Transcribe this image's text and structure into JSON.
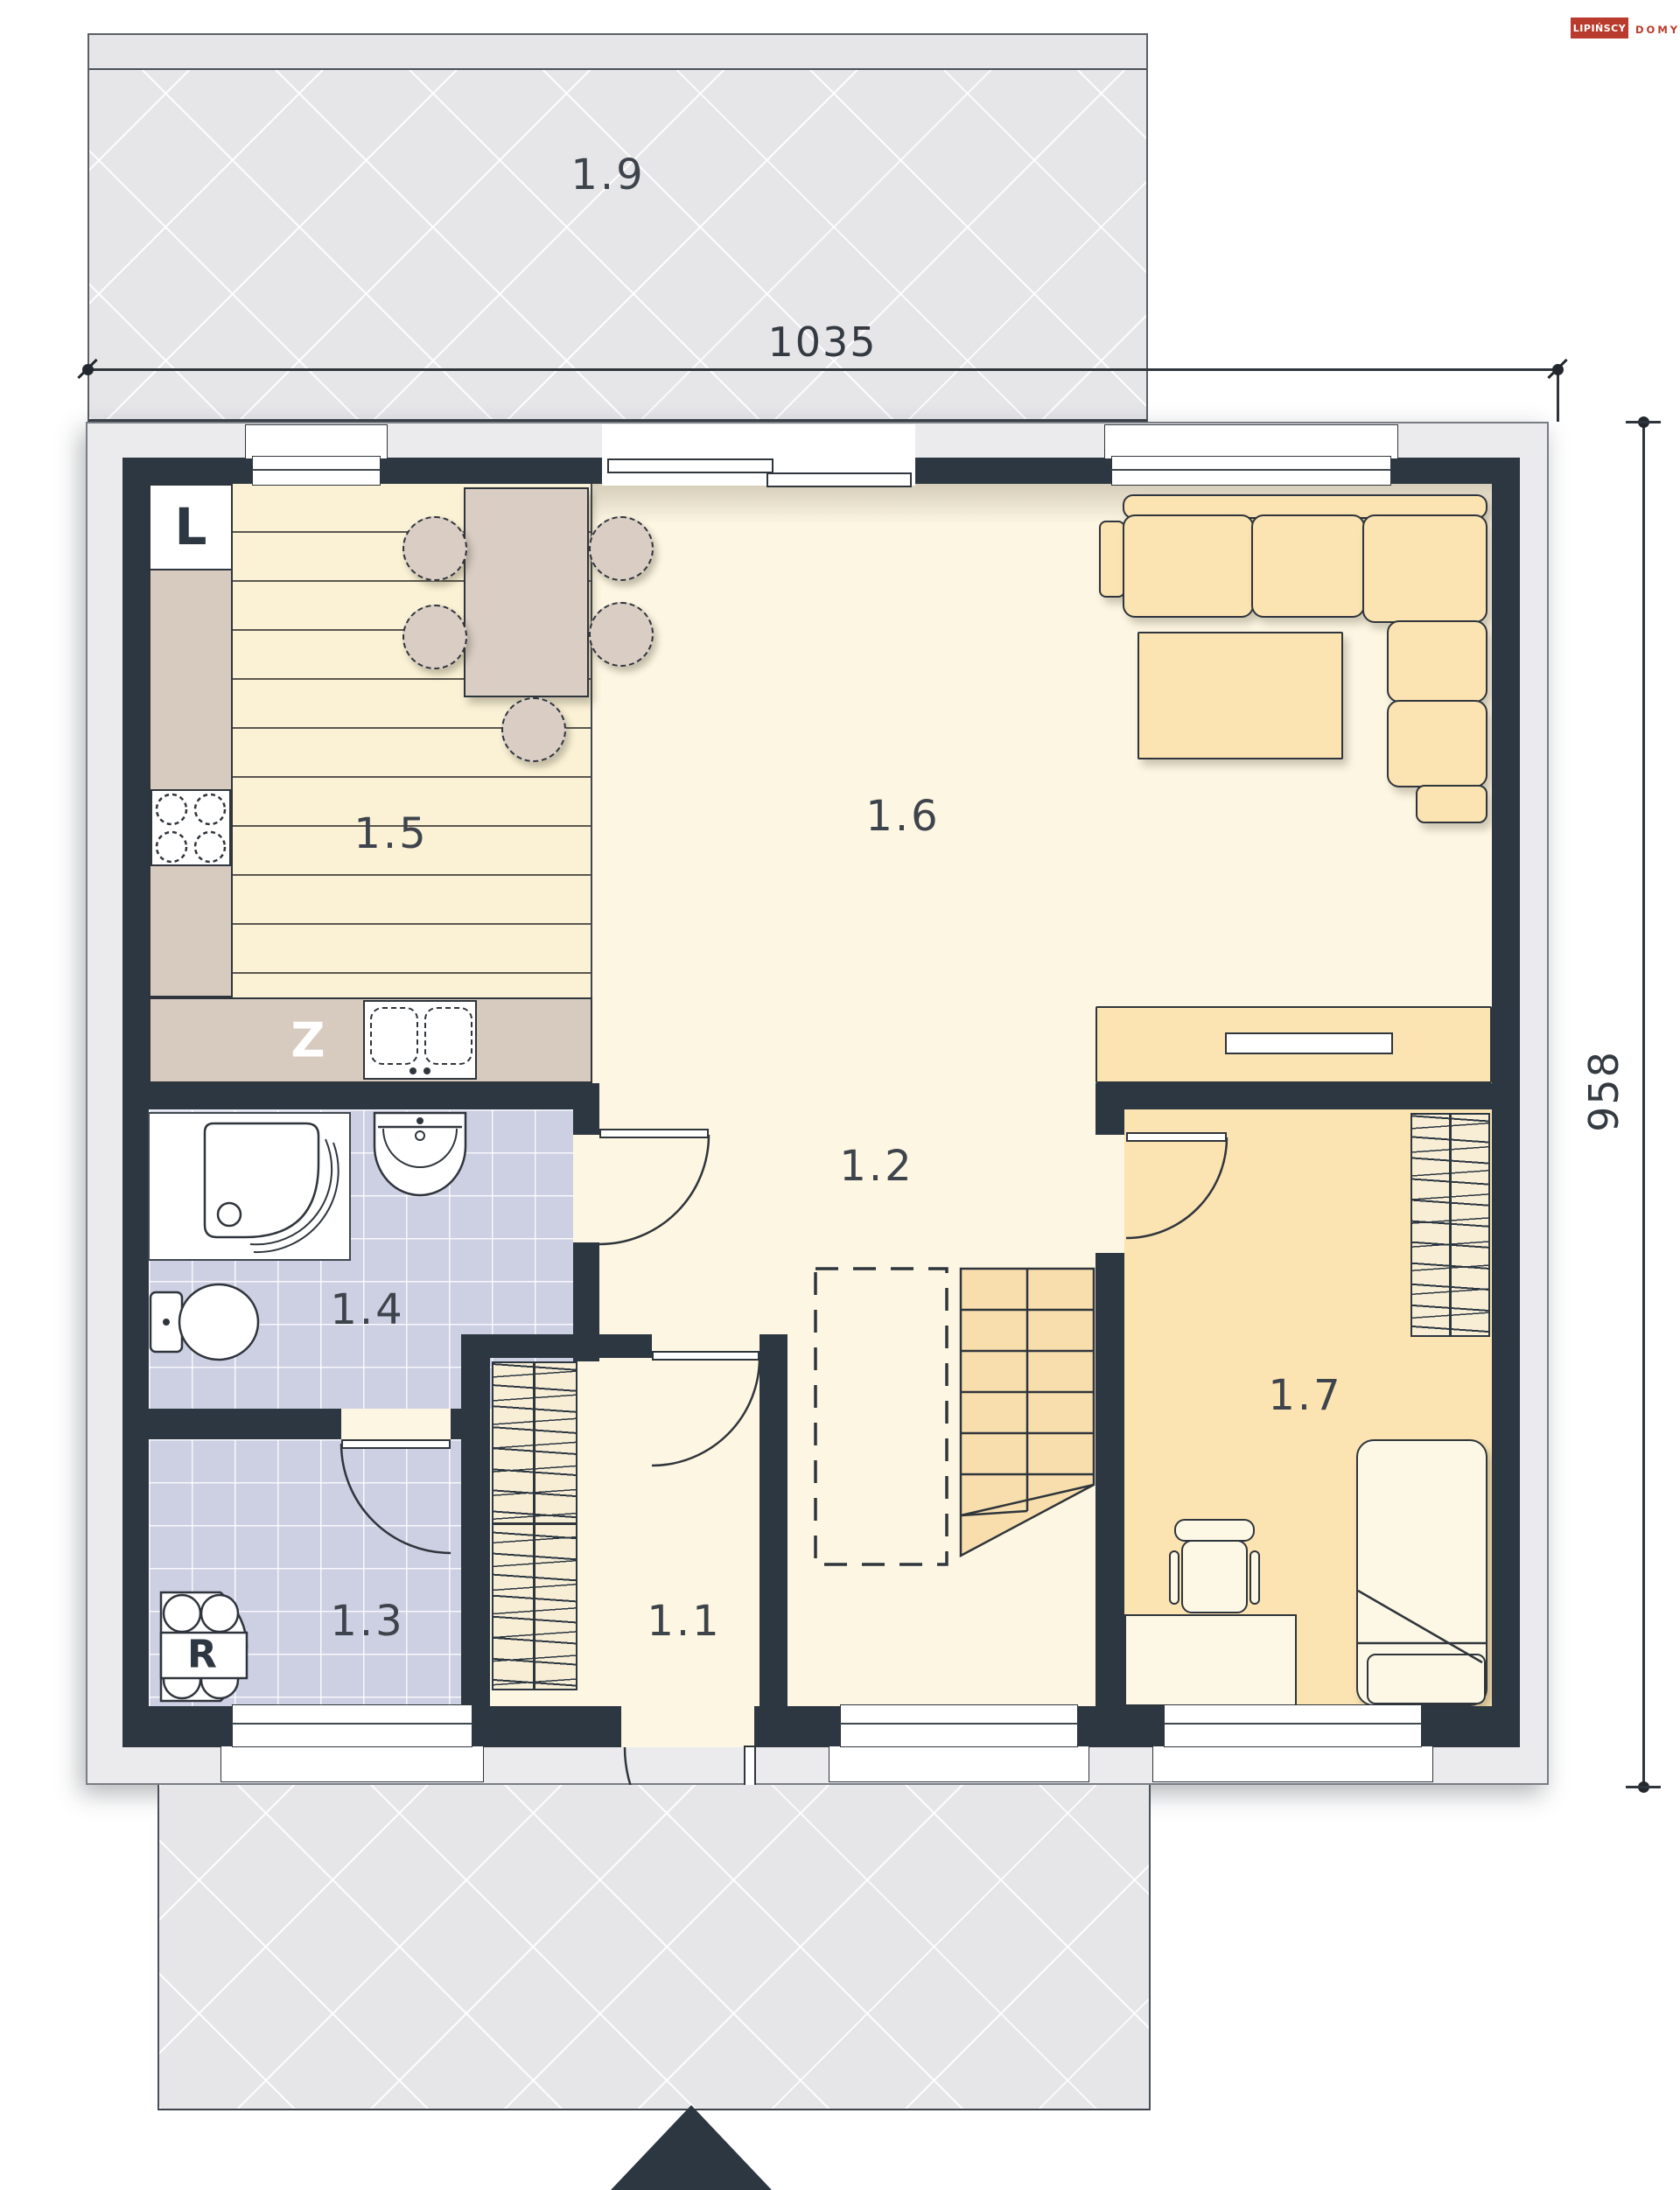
{
  "logo": {
    "brand": "LIPIŃSCY",
    "word": "DOMY"
  },
  "dimensions": {
    "width_label": "1035",
    "depth_label": "958"
  },
  "rooms": [
    {
      "id": "1.1",
      "label": "1.1",
      "type": "entrance-hall"
    },
    {
      "id": "1.2",
      "label": "1.2",
      "type": "hall-with-stairs"
    },
    {
      "id": "1.3",
      "label": "1.3",
      "type": "utility-room"
    },
    {
      "id": "1.4",
      "label": "1.4",
      "type": "bathroom"
    },
    {
      "id": "1.5",
      "label": "1.5",
      "type": "kitchen"
    },
    {
      "id": "1.6",
      "label": "1.6",
      "type": "living-room"
    },
    {
      "id": "1.7",
      "label": "1.7",
      "type": "bedroom"
    },
    {
      "id": "1.8",
      "label": "1.8",
      "type": "terrace-south"
    },
    {
      "id": "1.9",
      "label": "1.9",
      "type": "terrace-north"
    }
  ],
  "appliance_labels": {
    "fridge": "L",
    "sink_cabinet": "Z",
    "boiler": "R"
  },
  "colors": {
    "wall": "#2c3741",
    "terrace": "#e6e6e9",
    "tile_floor": "#cdcfe3",
    "wood_floor": "#fbf2d6",
    "cream_floor": "#fdf6e2",
    "furniture": "#fbe3b2",
    "counter": "#d7cabf",
    "logo_red": "#b93b2d"
  }
}
